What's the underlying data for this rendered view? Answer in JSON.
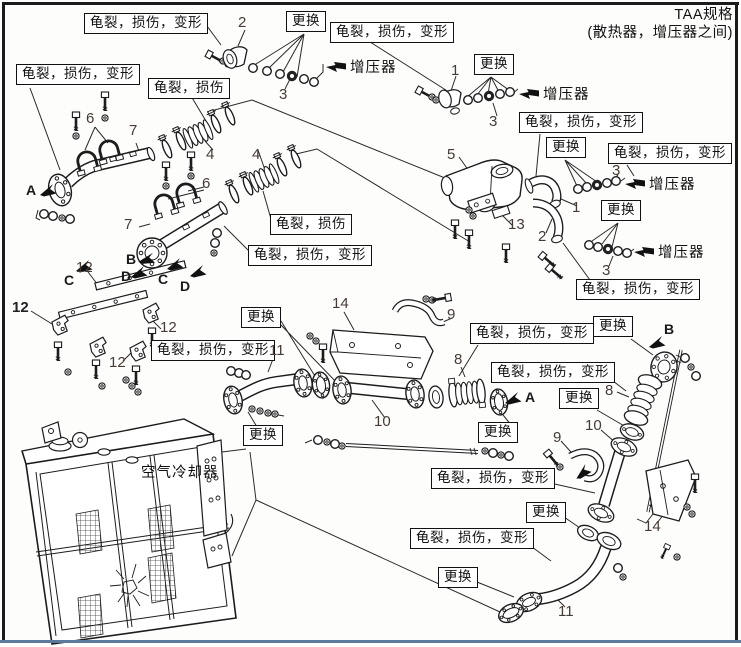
{
  "title": {
    "line1": "TAA规格",
    "line2": "(散热器，增压器之间)"
  },
  "labels": {
    "crack_damage_deform": "龟裂，损伤，变形",
    "crack_damage": "龟裂，损伤",
    "replace": "更换",
    "turbocharger": "增压器",
    "air_cooler": "空气冷却器"
  },
  "part_numbers": {
    "1": "1",
    "2": "2",
    "3": "3",
    "4": "4",
    "5": "5",
    "6": "6",
    "7": "7",
    "8": "8",
    "9": "9",
    "10": "10",
    "11": "11",
    "12": "12",
    "13": "13",
    "14": "14"
  },
  "ref_letters": {
    "A": "A",
    "B": "B",
    "C": "C",
    "D": "D"
  }
}
